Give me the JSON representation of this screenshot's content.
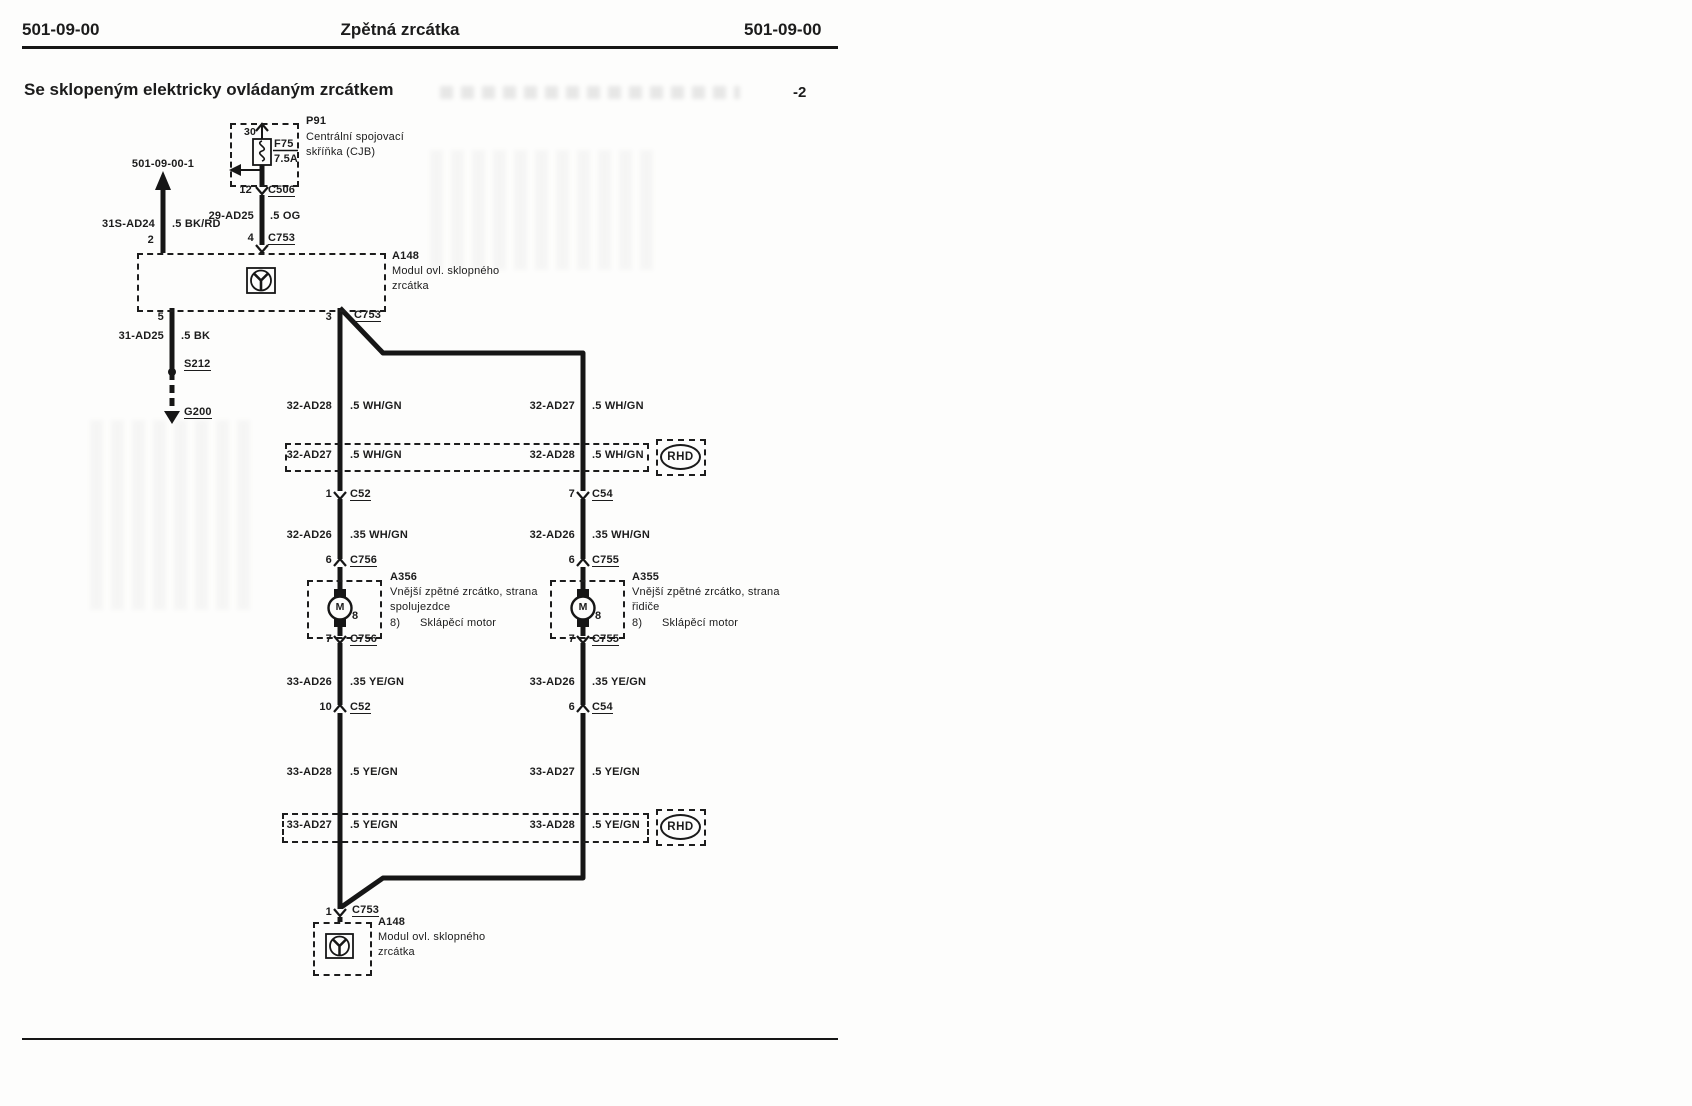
{
  "page": {
    "header_left": "501-09-00",
    "title": "Zpětná zrcátka",
    "header_right": "501-09-00",
    "subtitle": "Se sklopeným elektricky ovládaným zrcátkem",
    "page_suffix": "-2"
  },
  "offpage": {
    "ref": "501-09-00-1"
  },
  "fusebox": {
    "id": "P91",
    "desc1": "Centrální spojovací",
    "desc2": "skříňka (CJB)",
    "pin_top": "30",
    "fuse": "F75",
    "rating": "7.5A",
    "pin_out": "12",
    "conn_out": "C506"
  },
  "feed_wire": {
    "circuit": "29-AD25",
    "gauge": ".5 OG"
  },
  "batt_wire": {
    "circuit": "31S-AD24",
    "gauge": ".5 BK/RD"
  },
  "module_top": {
    "id": "A148",
    "desc1": "Modul ovl. sklopného",
    "desc2": "zrcátka",
    "pin_in_left": "2",
    "pin_in_right": "4",
    "conn_in": "C753",
    "pin_out_left": "5",
    "pin_out_right": "3",
    "conn_out": "C753"
  },
  "ground_branch": {
    "circuit": "31-AD25",
    "gauge": ".5 BK",
    "splice": "S212",
    "ground": "G200"
  },
  "left": {
    "wire1": {
      "circuit": "32-AD28",
      "gauge": ".5 WH/GN"
    },
    "conn1": {
      "pin": "1",
      "name": "C52"
    },
    "wire2": {
      "circuit": "32-AD26",
      "gauge": ".35 WH/GN"
    },
    "conn2": {
      "pin": "6",
      "name": "C756"
    },
    "conn3": {
      "pin": "7",
      "name": "C756"
    },
    "wire3": {
      "circuit": "33-AD26",
      "gauge": ".35 YE/GN"
    },
    "conn4": {
      "pin": "10",
      "name": "C52"
    },
    "wire4": {
      "circuit": "33-AD28",
      "gauge": ".5 YE/GN"
    }
  },
  "right": {
    "wire1": {
      "circuit": "32-AD27",
      "gauge": ".5 WH/GN"
    },
    "conn1": {
      "pin": "7",
      "name": "C54"
    },
    "wire2": {
      "circuit": "32-AD26",
      "gauge": ".35 WH/GN"
    },
    "conn2": {
      "pin": "6",
      "name": "C755"
    },
    "conn3": {
      "pin": "7",
      "name": "C755"
    },
    "wire3": {
      "circuit": "33-AD26",
      "gauge": ".35 YE/GN"
    },
    "conn4": {
      "pin": "6",
      "name": "C54"
    },
    "wire4": {
      "circuit": "33-AD27",
      "gauge": ".5 YE/GN"
    }
  },
  "rhd_upper": {
    "left_circuit": "32-AD27",
    "left_gauge": ".5 WH/GN",
    "right_circuit": "32-AD28",
    "right_gauge": ".5 WH/GN",
    "badge": "RHD"
  },
  "rhd_lower": {
    "left_circuit": "33-AD27",
    "left_gauge": ".5 YE/GN",
    "right_circuit": "33-AD28",
    "right_gauge": ".5 YE/GN",
    "badge": "RHD"
  },
  "mirror_passenger": {
    "id": "A356",
    "desc1": "Vnější zpětné zrcátko, strana",
    "desc2": "spolujezdce",
    "item_no": "8)",
    "item_label": "Sklápěcí motor",
    "callout": "8",
    "symbol": "M"
  },
  "mirror_driver": {
    "id": "A355",
    "desc1": "Vnější zpětné zrcátko, strana",
    "desc2": "řidiče",
    "item_no": "8)",
    "item_label": "Sklápěcí motor",
    "callout": "8",
    "symbol": "M"
  },
  "module_bottom": {
    "id": "A148",
    "desc1": "Modul ovl. sklopného",
    "desc2": "zrcátka",
    "pin": "1",
    "conn": "C753"
  }
}
